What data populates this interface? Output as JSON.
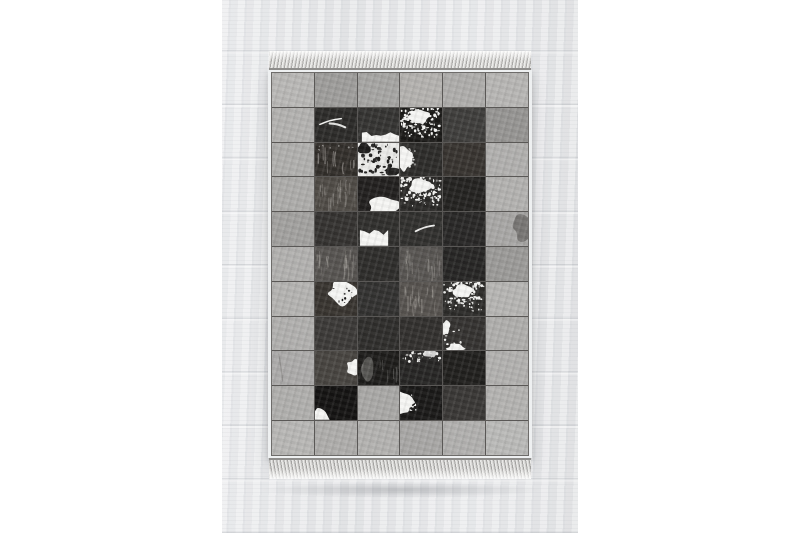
{
  "scene": {
    "description": "Product photo of a rectangular patchwork cowhide rug in black, white and grey squares with fringed short ends, lying on a whitewashed wooden plank floor, white page margins left and right",
    "page_background": "#ffffff",
    "floor": {
      "base_color": "#e5e6e8",
      "plank_seam_color": "#c7cad0",
      "band_left_px": 222,
      "band_width_px": 356
    },
    "rug": {
      "left_px": 268,
      "top_px": 51,
      "width_px": 264,
      "columns": 6,
      "rows": 11,
      "binding_color": "#eef0f1",
      "seam_color": "#5a5856",
      "fringe_light": "#ececea",
      "fringe_dark": "#a9a8a6",
      "spot_white": "#f6f6f4",
      "spot_black": "#1c1b1a",
      "grid": [
        [
          {
            "tone": "#b9b8b6"
          },
          {
            "tone": "#9e9d9b"
          },
          {
            "tone": "#a6a5a3"
          },
          {
            "tone": "#b4b2af"
          },
          {
            "tone": "#aeadab"
          },
          {
            "tone": "#b7b6b4"
          }
        ],
        [
          {
            "tone": "#b3b2b0"
          },
          {
            "tone": "#2b2a28",
            "pattern": "streak-white"
          },
          {
            "tone": "#343331",
            "pattern": "white-strip-bottom"
          },
          {
            "tone": "#1a1917",
            "pattern": "speckle-white-dense"
          },
          {
            "tone": "#3e3d3b"
          },
          {
            "tone": "#969593"
          }
        ],
        [
          {
            "tone": "#b0afad"
          },
          {
            "tone": "#322e2a",
            "pattern": "wisp-top"
          },
          {
            "tone": "#ebebe9",
            "pattern": "speckle-black-heavy"
          },
          {
            "tone": "#2c2b29",
            "pattern": "white-blob-left"
          },
          {
            "tone": "#37332f"
          },
          {
            "tone": "#b1b0ae"
          }
        ],
        [
          {
            "tone": "#adacaa"
          },
          {
            "tone": "#4e4a45",
            "pattern": "fur-texture"
          },
          {
            "tone": "#211f1e",
            "pattern": "white-blob-bottom-right"
          },
          {
            "tone": "#2a2927",
            "pattern": "speckle-white-dense"
          },
          {
            "tone": "#232220"
          },
          {
            "tone": "#b3b2b0"
          }
        ],
        [
          {
            "tone": "#a2a19f"
          },
          {
            "tone": "#343230"
          },
          {
            "tone": "#2f2e2c",
            "pattern": "white-jagged-bottom"
          },
          {
            "tone": "#302f2d",
            "pattern": "streak-white-small"
          },
          {
            "tone": "#282726"
          },
          {
            "tone": "#a8a7a5",
            "pattern": "shade-right"
          }
        ],
        [
          {
            "tone": "#b2b1af"
          },
          {
            "tone": "#565350",
            "pattern": "fur-texture"
          },
          {
            "tone": "#2d2c2a"
          },
          {
            "tone": "#575451",
            "pattern": "fur-texture"
          },
          {
            "tone": "#262524"
          },
          {
            "tone": "#9b9a98"
          }
        ],
        [
          {
            "tone": "#b4b3b1"
          },
          {
            "tone": "#38342f",
            "pattern": "white-blob-right-speckled"
          },
          {
            "tone": "#323130"
          },
          {
            "tone": "#56524e",
            "pattern": "fur-texture"
          },
          {
            "tone": "#2c2b29",
            "pattern": "speckle-white-dense"
          },
          {
            "tone": "#b6b5b3"
          }
        ],
        [
          {
            "tone": "#b1b0ae"
          },
          {
            "tone": "#3b3937"
          },
          {
            "tone": "#2e2d2b"
          },
          {
            "tone": "#312f2d"
          },
          {
            "tone": "#343230",
            "pattern": "white-splotch-left-bottom"
          },
          {
            "tone": "#afaeac"
          }
        ],
        [
          {
            "tone": "#acabaa",
            "pattern": "faint-streak"
          },
          {
            "tone": "#474440",
            "pattern": "white-wedge-right"
          },
          {
            "tone": "#1d1c1a",
            "pattern": "gray-wisp"
          },
          {
            "tone": "#262524",
            "pattern": "speckle-white-top"
          },
          {
            "tone": "#201f1d"
          },
          {
            "tone": "#b2b1af"
          }
        ],
        [
          {
            "tone": "#b0afad"
          },
          {
            "tone": "#141312",
            "pattern": "white-corner-bl"
          },
          {
            "tone": "#a9a8a6"
          },
          {
            "tone": "#1a1918",
            "pattern": "white-blob-left"
          },
          {
            "tone": "#393735"
          },
          {
            "tone": "#b4b3b1"
          }
        ],
        [
          {
            "tone": "#b8b7b5"
          },
          {
            "tone": "#aeadab"
          },
          {
            "tone": "#b3b2b0"
          },
          {
            "tone": "#a8a7a5"
          },
          {
            "tone": "#b1b0ae"
          },
          {
            "tone": "#babab8"
          }
        ]
      ]
    }
  }
}
